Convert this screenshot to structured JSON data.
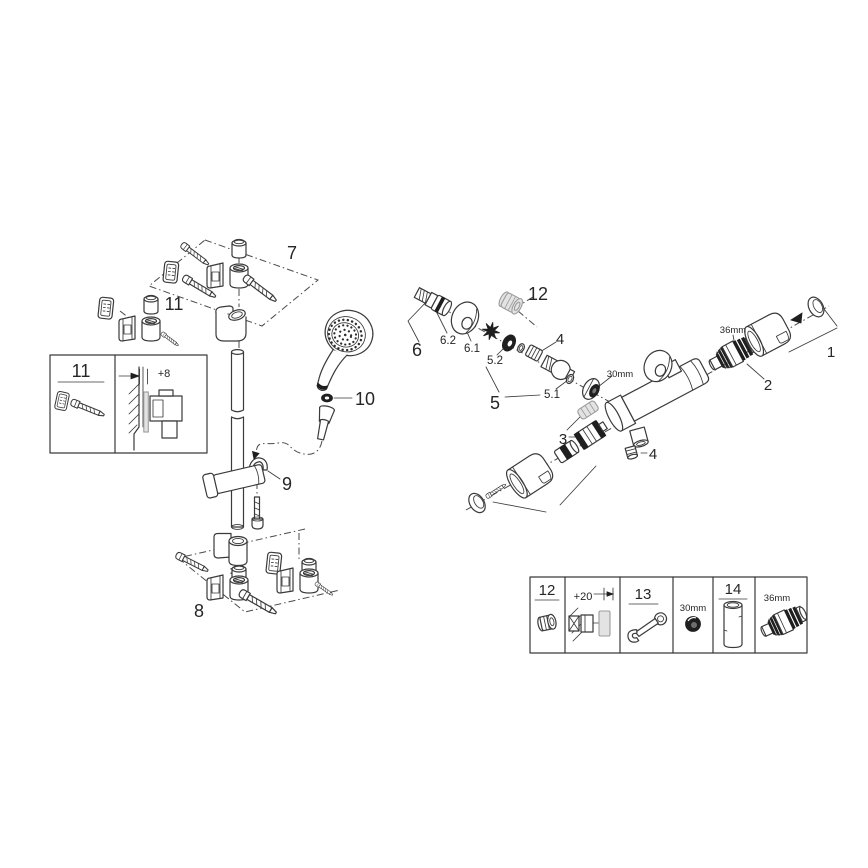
{
  "document_type": "exploded-parts-diagram",
  "colors": {
    "background": "#ffffff",
    "line": "#3a3a3a",
    "gray_part": "#9c9c9c",
    "dark_fill": "#1f1f1f"
  },
  "shower_rail_assembly": {
    "callout_top_bracket": "7",
    "callout_anchor_set": "11",
    "callout_slider_holder": "9",
    "callout_bottom_bracket": "8",
    "callout_hose_washer": "10",
    "inset": {
      "callout": "11",
      "offset_dimension": "+8"
    }
  },
  "thermostat_assembly": {
    "callout_handle_group_right": "1",
    "callout_cartridge": "2",
    "callout_cartridge_size": "36mm",
    "callout_aquadimmer_group": "3",
    "callout_bushing_top": "4",
    "callout_screw_bottom": "4",
    "callout_union_group": "5",
    "callout_union_oring": "5.1",
    "callout_union_seal": "5.2",
    "callout_inlet_group": "6",
    "callout_escutcheon": "6.1",
    "callout_check_valve": "6.2",
    "callout_plug_cap": "12",
    "callout_nut_size": "30mm"
  },
  "legend_table": {
    "cells": [
      {
        "label": "12",
        "icon": "plug-cap-icon"
      },
      {
        "label": "+20",
        "icon": "wall-extension-kit-icon"
      },
      {
        "label": "13",
        "icon": "open-end-wrench-icon"
      },
      {
        "label": "30mm",
        "icon": "socket-nut-icon"
      },
      {
        "label": "14",
        "icon": "extension-tube-icon"
      },
      {
        "label": "36mm",
        "icon": "thermostat-cartridge-icon"
      }
    ]
  }
}
